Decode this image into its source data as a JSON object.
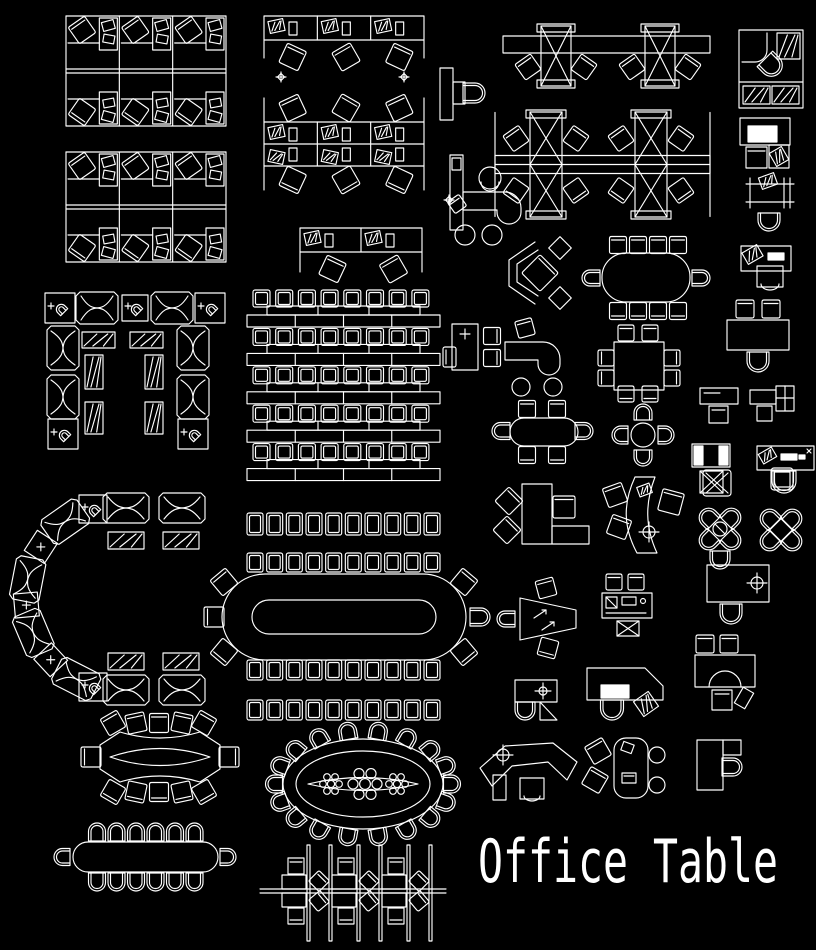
{
  "canvas": {
    "width": 816,
    "height": 950,
    "background": "#000000",
    "line_color": "#ffffff"
  },
  "title": {
    "text": "Office Table"
  },
  "blocks": [
    {
      "name": "cubicle-cluster-top-left-1",
      "type": "cubicleGrid",
      "x": 66,
      "y": 16,
      "w": 160,
      "h": 110
    },
    {
      "name": "cubicle-cluster-top-left-2",
      "type": "cubicleGrid",
      "x": 66,
      "y": 152,
      "w": 160,
      "h": 110
    },
    {
      "name": "cubicle-row-top-middle",
      "type": "cubicleRow",
      "x": 264,
      "y": 16,
      "w": 160,
      "h": 56,
      "cols": 3
    },
    {
      "name": "cubicle-cluster-middle",
      "type": "cubicleGrid2",
      "x": 264,
      "y": 90,
      "w": 160,
      "h": 108
    },
    {
      "name": "cubicle-row-small",
      "type": "cubicleRow",
      "x": 300,
      "y": 228,
      "w": 122,
      "h": 58,
      "cols": 2
    },
    {
      "name": "sparkle-left",
      "type": "sparkle",
      "x": 281,
      "y": 77
    },
    {
      "name": "sparkle-right",
      "type": "sparkle",
      "x": 404,
      "y": 77
    },
    {
      "name": "sparkle-lower",
      "type": "sparkle",
      "x": 449,
      "y": 200
    },
    {
      "name": "panel-desk-chair",
      "type": "panelDeskChair",
      "x": 440,
      "y": 68,
      "w": 38,
      "h": 52
    },
    {
      "name": "x-workstation-row",
      "type": "xRow",
      "x": 503,
      "y": 30,
      "w": 207,
      "h": 62
    },
    {
      "name": "x-workstation-cluster",
      "type": "xCluster",
      "x": 495,
      "y": 112,
      "w": 215,
      "h": 105
    },
    {
      "name": "l-counter-stools",
      "type": "lCounter",
      "x": 450,
      "y": 152,
      "w": 85,
      "h": 95
    },
    {
      "name": "executive-office",
      "type": "execOffice",
      "x": 739,
      "y": 30,
      "w": 64,
      "h": 82
    },
    {
      "name": "desk-monitor",
      "type": "deskMonitor",
      "x": 740,
      "y": 118,
      "w": 52,
      "h": 50
    },
    {
      "name": "drafting-table",
      "type": "drafting",
      "x": 746,
      "y": 178,
      "w": 48,
      "h": 56
    },
    {
      "name": "desk-with-items",
      "type": "deskItems",
      "x": 741,
      "y": 246,
      "w": 52,
      "h": 42
    },
    {
      "name": "corner-diamond-desk",
      "type": "diamondDesk",
      "x": 505,
      "y": 238,
      "w": 68,
      "h": 70
    },
    {
      "name": "conference-racetrack-10",
      "type": "racetrack10",
      "x": 583,
      "y": 238,
      "w": 124,
      "h": 82
    },
    {
      "name": "sofa-u-group",
      "type": "sofaU",
      "x": 42,
      "y": 292,
      "w": 192,
      "h": 172
    },
    {
      "name": "classroom-rows",
      "type": "classroom",
      "x": 247,
      "y": 290,
      "w": 193,
      "h": 192
    },
    {
      "name": "classroom-stray-chair",
      "type": "vchair",
      "x": 443,
      "y": 347,
      "w": 13,
      "h": 20
    },
    {
      "name": "cabinet-with-chairs",
      "type": "cabinetChairs",
      "x": 452,
      "y": 322,
      "w": 52,
      "h": 50
    },
    {
      "name": "j-desk-stools",
      "type": "jDesk",
      "x": 505,
      "y": 322,
      "w": 70,
      "h": 72
    },
    {
      "name": "conference-rect-8",
      "type": "rectConf8",
      "x": 598,
      "y": 322,
      "w": 88,
      "h": 80
    },
    {
      "name": "desk-two-chairs",
      "type": "deskTwoChairs",
      "x": 727,
      "y": 300,
      "w": 62,
      "h": 72
    },
    {
      "name": "capsule-conference-6",
      "type": "capsule6",
      "x": 490,
      "y": 396,
      "w": 105,
      "h": 70
    },
    {
      "name": "round-table-cross",
      "type": "roundCross",
      "x": 618,
      "y": 398,
      "w": 52,
      "h": 68
    },
    {
      "name": "small-desk-chair",
      "type": "smallDeskChair",
      "x": 700,
      "y": 386,
      "w": 40,
      "h": 38
    },
    {
      "name": "corner-desk-cross",
      "type": "cornerDeskCross",
      "x": 750,
      "y": 386,
      "w": 44,
      "h": 40
    },
    {
      "name": "panel-side-desk",
      "type": "panelDesk",
      "x": 692,
      "y": 444,
      "w": 40,
      "h": 52
    },
    {
      "name": "screen-desk",
      "type": "screenDesk",
      "x": 757,
      "y": 446,
      "w": 58,
      "h": 50
    },
    {
      "name": "stool-row-1",
      "type": "stoolRow",
      "x": 247,
      "y": 513,
      "w": 193,
      "h": 22,
      "count": 10
    },
    {
      "name": "stool-row-2",
      "type": "stoolRow",
      "x": 247,
      "y": 553,
      "w": 193,
      "h": 19,
      "count": 10
    },
    {
      "name": "conference-racetrack-large",
      "type": "racetrackLarge",
      "x": 222,
      "y": 574,
      "w": 244,
      "h": 86
    },
    {
      "name": "stool-row-3",
      "type": "stoolRow",
      "x": 247,
      "y": 660,
      "w": 193,
      "h": 20,
      "count": 10
    },
    {
      "name": "stool-row-4",
      "type": "stoolRow",
      "x": 247,
      "y": 700,
      "w": 193,
      "h": 20,
      "count": 10
    },
    {
      "name": "sofa-c-group",
      "type": "sofaC",
      "x": 15,
      "y": 490,
      "w": 215,
      "h": 215
    },
    {
      "name": "l-desk-large",
      "type": "lDeskBig",
      "x": 495,
      "y": 480,
      "w": 100,
      "h": 66
    },
    {
      "name": "curved-desk",
      "type": "curvedDesk",
      "x": 605,
      "y": 475,
      "w": 82,
      "h": 82
    },
    {
      "name": "chair-x-small",
      "type": "chairGlyphX",
      "x": 703,
      "y": 470,
      "w": 28,
      "h": 26
    },
    {
      "name": "chair-plain-small",
      "type": "chairGlyphP",
      "x": 771,
      "y": 468,
      "w": 22,
      "h": 22
    },
    {
      "name": "flower-table-1",
      "type": "flower1",
      "x": 720,
      "y": 529
    },
    {
      "name": "flower-table-2",
      "type": "flower2",
      "x": 781,
      "y": 530
    },
    {
      "name": "trapezoid-table",
      "type": "trapTable",
      "x": 498,
      "y": 578,
      "w": 80,
      "h": 78
    },
    {
      "name": "copier-station",
      "type": "copier",
      "x": 600,
      "y": 573,
      "w": 54,
      "h": 66
    },
    {
      "name": "exec-desk-crosshair",
      "type": "execDeskTarget",
      "x": 705,
      "y": 563,
      "w": 66,
      "h": 62
    },
    {
      "name": "u-desk-group",
      "type": "uDesk",
      "x": 693,
      "y": 633,
      "w": 66,
      "h": 76
    },
    {
      "name": "corner-workstation",
      "type": "cornerWs",
      "x": 585,
      "y": 665,
      "w": 82,
      "h": 56
    },
    {
      "name": "small-l-desk",
      "type": "smallLDesk",
      "x": 513,
      "y": 678,
      "w": 46,
      "h": 44
    },
    {
      "name": "boat-conference-table",
      "type": "boatTable",
      "x": 80,
      "y": 710,
      "w": 160,
      "h": 100
    },
    {
      "name": "oval-banquet-table",
      "type": "ovalTable",
      "x": 278,
      "y": 732,
      "w": 170,
      "h": 104
    },
    {
      "name": "reception-desk",
      "type": "receptionDesk",
      "x": 478,
      "y": 738,
      "w": 102,
      "h": 62
    },
    {
      "name": "rounded-desk",
      "type": "roundedDesk",
      "x": 586,
      "y": 735,
      "w": 78,
      "h": 64
    },
    {
      "name": "f-desk",
      "type": "fDesk",
      "x": 695,
      "y": 736,
      "w": 50,
      "h": 56
    },
    {
      "name": "capsule-table-long",
      "type": "capsuleLong",
      "x": 55,
      "y": 820,
      "w": 180,
      "h": 76
    },
    {
      "name": "spine-workstations",
      "type": "spineWs",
      "x": 262,
      "y": 843,
      "w": 182,
      "h": 104
    }
  ]
}
